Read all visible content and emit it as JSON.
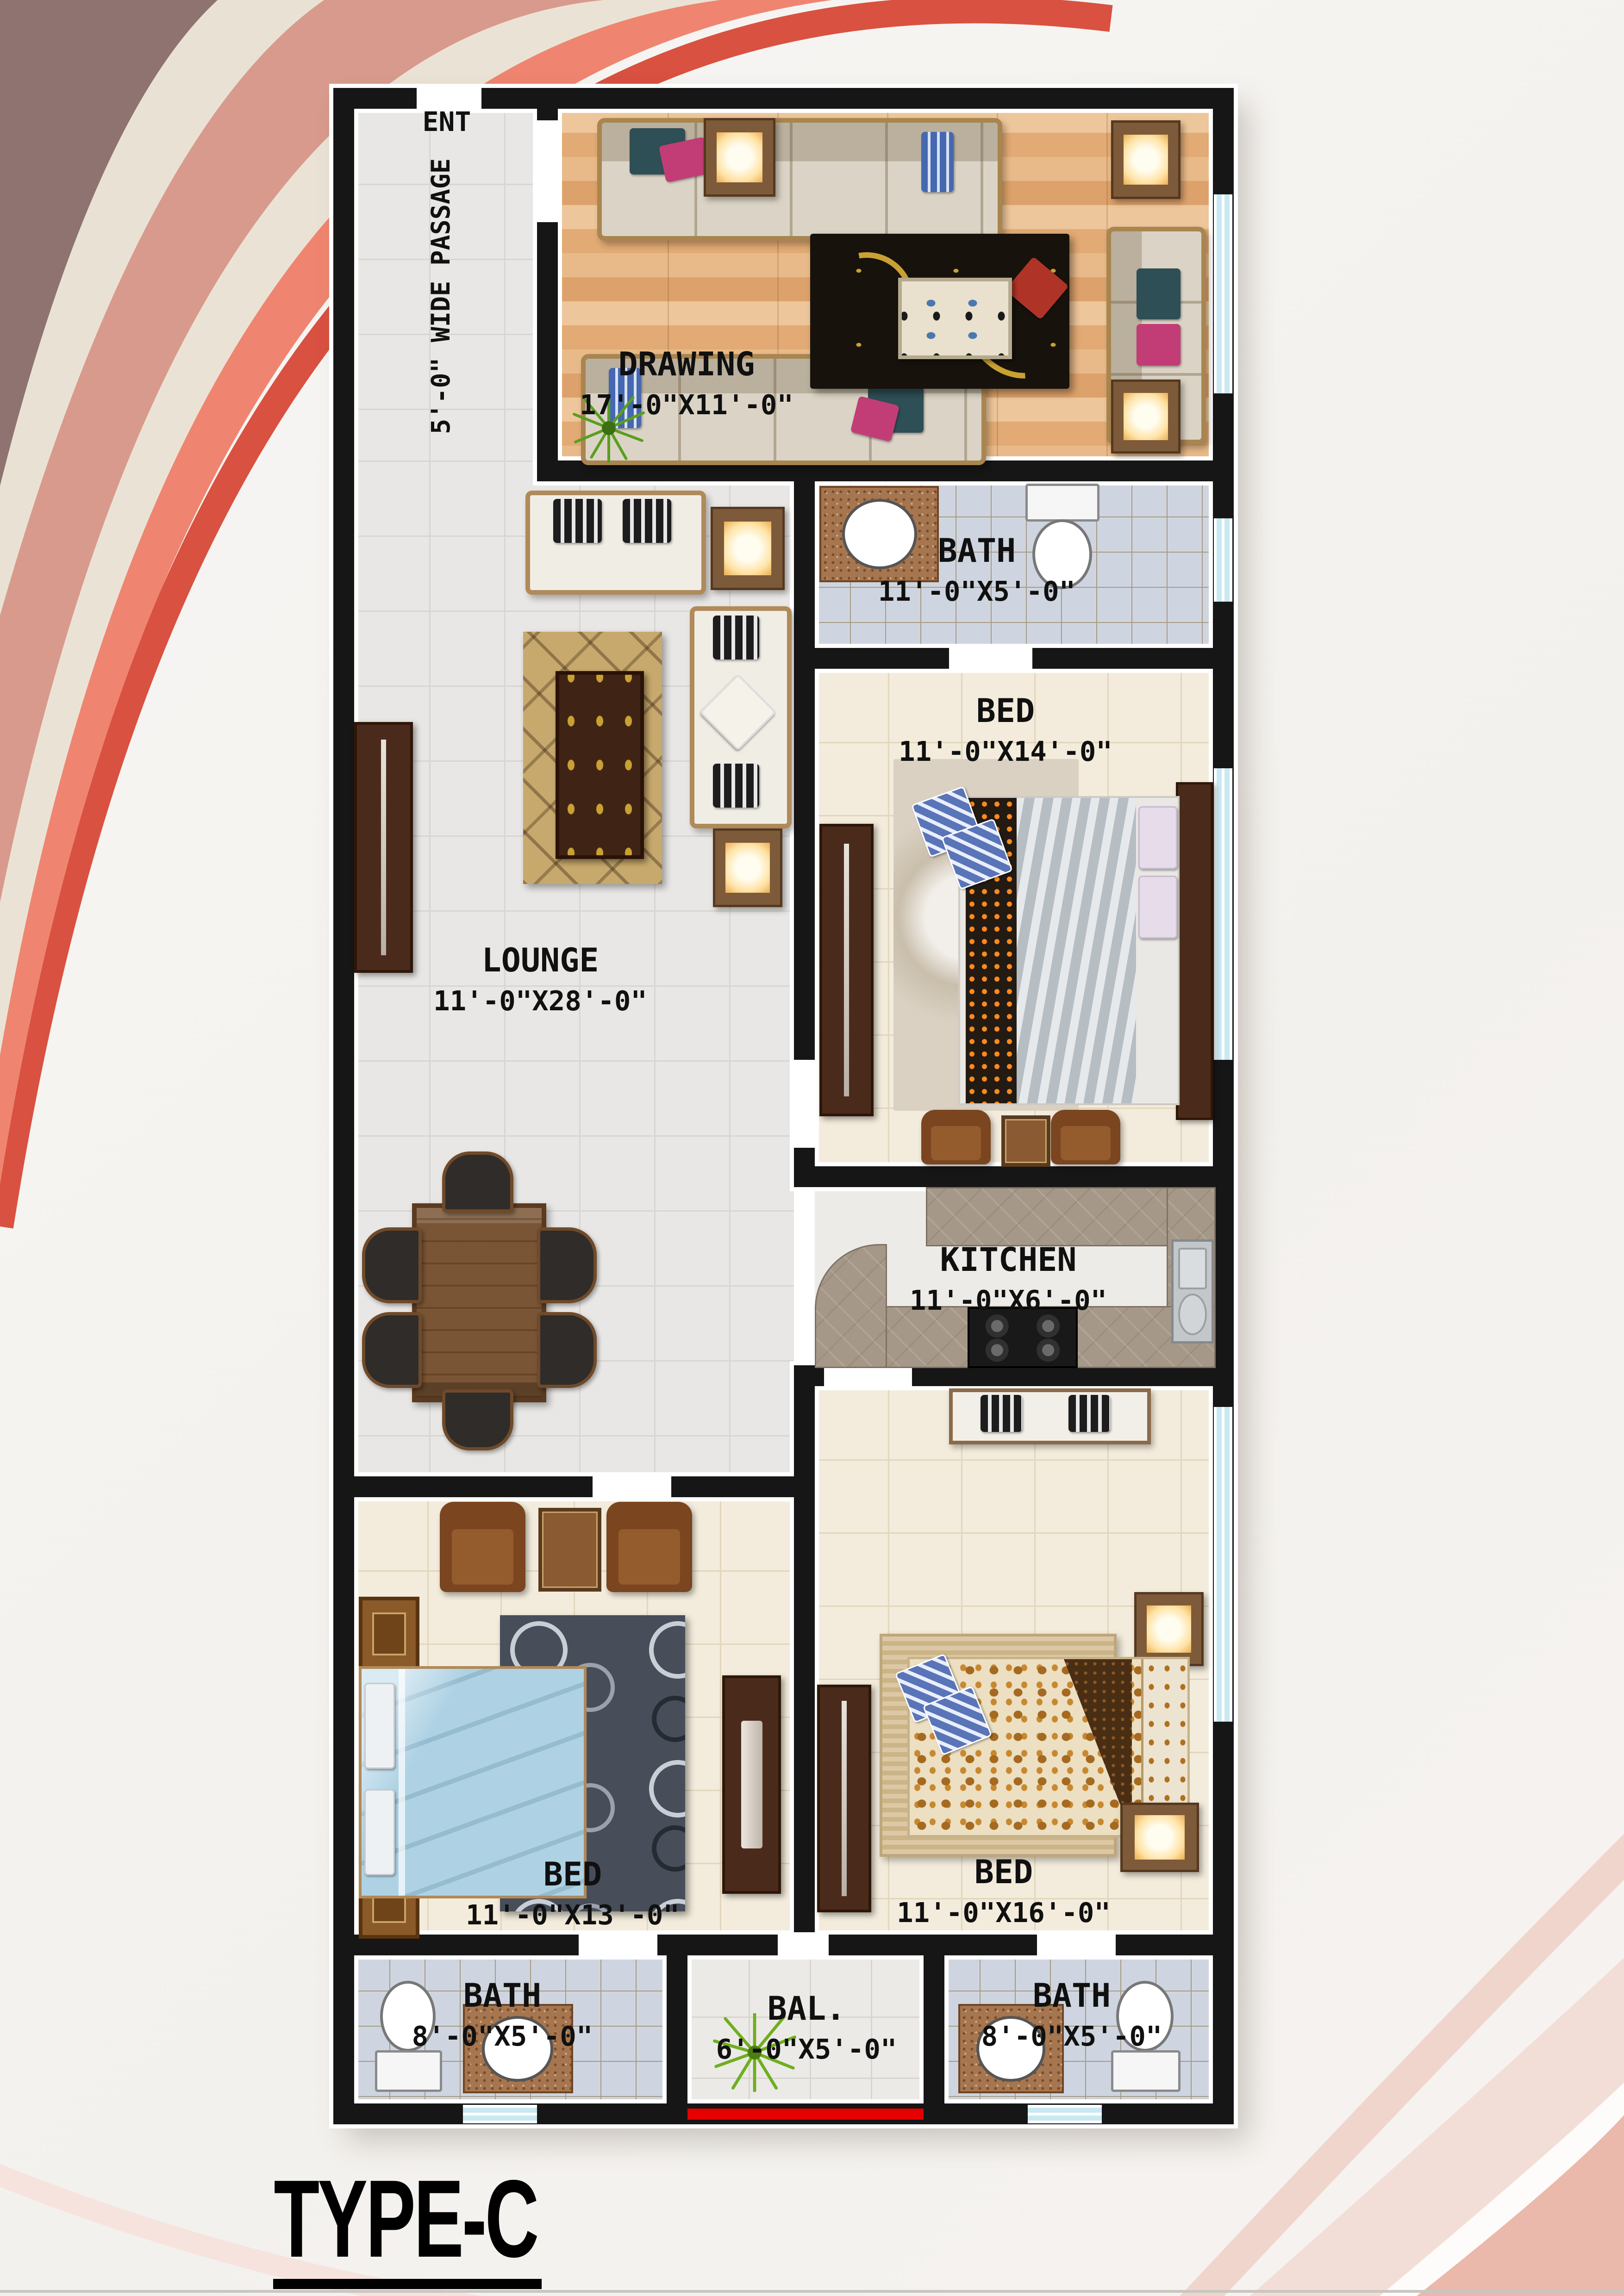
{
  "labels": {
    "title": "TYPE-C",
    "ent": "ENT",
    "passage": "5'-0\" WIDE PASSAGE"
  },
  "rooms": {
    "drawing": {
      "name": "DRAWING",
      "dims": "17'-0\"X11'-0\""
    },
    "bath_top": {
      "name": "BATH",
      "dims": "11'-0\"X5'-0\""
    },
    "bed_mid": {
      "name": "BED",
      "dims": "11'-0\"X14'-0\""
    },
    "lounge": {
      "name": "LOUNGE",
      "dims": "11'-0\"X28'-0\""
    },
    "kitchen": {
      "name": "KITCHEN",
      "dims": "11'-0\"X6'-0\""
    },
    "bed_left": {
      "name": "BED",
      "dims": "11'-0\"X13'-0\""
    },
    "bed_right": {
      "name": "BED",
      "dims": "11'-0\"X16'-0\""
    },
    "bath_left": {
      "name": "BATH",
      "dims": "8'-0\"X5'-0\""
    },
    "balcony": {
      "name": "BAL.",
      "dims": "6'-0\"X5'-0\""
    },
    "bath_right": {
      "name": "BATH",
      "dims": "8'-0\"X5'-0\""
    }
  },
  "palette": {
    "wall": "#161616",
    "window": "#c9e9f2",
    "accent_red": "#e60000",
    "floor_gray": "#e8e7e5",
    "floor_cream": "#f3ecdc",
    "floor_bath": "#ced5e0",
    "floor_wood": "#e2aa74",
    "swirl_dark": "#8e7370",
    "swirl_cream": "#e9e2d4",
    "swirl_salmon": "#d89a8c",
    "swirl_coral": "#ef8570",
    "swirl_red_arc": "#d95140",
    "corner_pink": "#f3ded7"
  }
}
